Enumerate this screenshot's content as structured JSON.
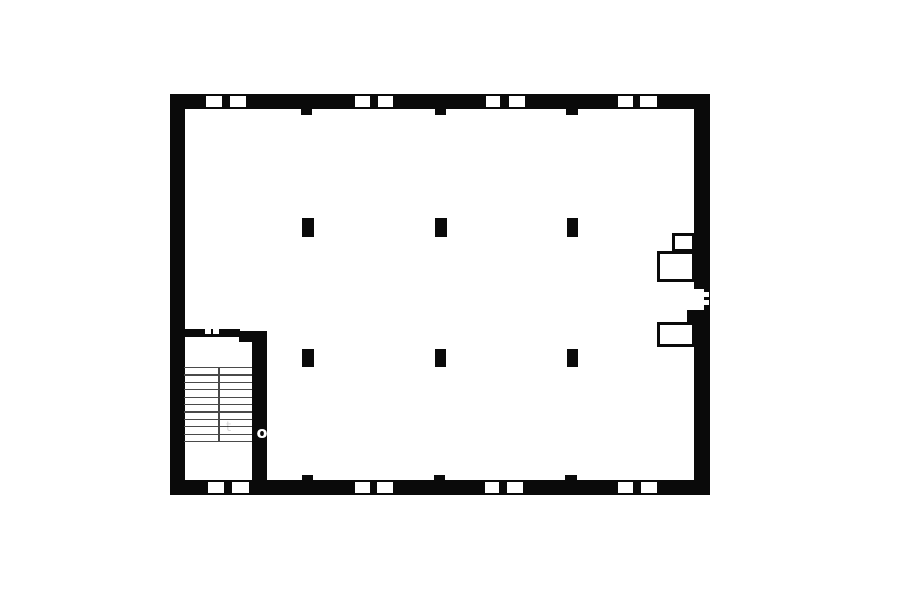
{
  "page": {
    "width": 900,
    "height": 604,
    "background": "#ffffff"
  },
  "floorplan": {
    "ink": "#0a0a0a",
    "paper": "#ffffff",
    "tread_color": "#4a4a4a",
    "walls": [
      {
        "name": "top-wall",
        "x": 170,
        "y": 94,
        "w": 540,
        "h": 15
      },
      {
        "name": "bottom-wall",
        "x": 170,
        "y": 480,
        "w": 540,
        "h": 15
      },
      {
        "name": "left-wall",
        "x": 170,
        "y": 94,
        "w": 15,
        "h": 401
      },
      {
        "name": "right-wall-upper",
        "x": 694,
        "y": 94,
        "w": 16,
        "h": 195
      },
      {
        "name": "right-wall-lower",
        "x": 694,
        "y": 310,
        "w": 16,
        "h": 185
      },
      {
        "name": "door-jamb-strip",
        "x": 703.5,
        "y": 289,
        "w": 6.5,
        "h": 21
      },
      {
        "name": "door-pier",
        "x": 686.5,
        "y": 310,
        "w": 8,
        "h": 13
      },
      {
        "name": "stair-top-wall",
        "x": 185,
        "y": 329,
        "w": 55,
        "h": 8
      },
      {
        "name": "stair-wall-head",
        "x": 239,
        "y": 331,
        "w": 28,
        "h": 11
      },
      {
        "name": "stair-side-wall",
        "x": 252,
        "y": 338,
        "w": 15,
        "h": 142
      }
    ],
    "piers": [
      {
        "name": "pier-top-1",
        "x": 300.5,
        "y": 109,
        "w": 11,
        "h": 5.5
      },
      {
        "name": "pier-top-2",
        "x": 434.5,
        "y": 109,
        "w": 11,
        "h": 5.5
      },
      {
        "name": "pier-top-3",
        "x": 565.5,
        "y": 109,
        "w": 12,
        "h": 5.5
      },
      {
        "name": "pier-bottom-1",
        "x": 301.5,
        "y": 475,
        "w": 11.5,
        "h": 5
      },
      {
        "name": "pier-bottom-2",
        "x": 433.5,
        "y": 475,
        "w": 11.5,
        "h": 5
      },
      {
        "name": "pier-bottom-3",
        "x": 565,
        "y": 475,
        "w": 12,
        "h": 5
      }
    ],
    "columns": [
      {
        "name": "column-r1-c1",
        "x": 301.5,
        "y": 218,
        "w": 12,
        "h": 18.5
      },
      {
        "name": "column-r1-c2",
        "x": 435,
        "y": 218,
        "w": 11.5,
        "h": 18.5
      },
      {
        "name": "column-r1-c3",
        "x": 566.5,
        "y": 218,
        "w": 11.5,
        "h": 18.5
      },
      {
        "name": "column-r2-c1",
        "x": 301.5,
        "y": 348.5,
        "w": 12,
        "h": 18
      },
      {
        "name": "column-r2-c2",
        "x": 434.5,
        "y": 348.5,
        "w": 11.5,
        "h": 18
      },
      {
        "name": "column-r2-c3",
        "x": 566.5,
        "y": 348.5,
        "w": 11.5,
        "h": 18
      }
    ],
    "window_openings": [
      {
        "name": "window-top-1",
        "x": 206,
        "y": 96,
        "w": 15.5,
        "h": 11
      },
      {
        "name": "window-top-2",
        "x": 230,
        "y": 96,
        "w": 16,
        "h": 11
      },
      {
        "name": "window-top-3",
        "x": 354.5,
        "y": 96,
        "w": 15,
        "h": 11
      },
      {
        "name": "window-top-4",
        "x": 377.5,
        "y": 96,
        "w": 15.5,
        "h": 11
      },
      {
        "name": "window-top-5",
        "x": 486,
        "y": 96,
        "w": 14,
        "h": 11
      },
      {
        "name": "window-top-6",
        "x": 508.5,
        "y": 96,
        "w": 16,
        "h": 11
      },
      {
        "name": "window-top-7",
        "x": 617.5,
        "y": 96,
        "w": 15,
        "h": 11
      },
      {
        "name": "window-top-8",
        "x": 639.5,
        "y": 96,
        "w": 17.5,
        "h": 11
      },
      {
        "name": "window-bottom-1",
        "x": 208,
        "y": 481.5,
        "w": 16,
        "h": 11
      },
      {
        "name": "window-bottom-2",
        "x": 231.5,
        "y": 481.5,
        "w": 17.5,
        "h": 11
      },
      {
        "name": "window-bottom-3",
        "x": 355,
        "y": 481.5,
        "w": 15,
        "h": 11
      },
      {
        "name": "window-bottom-4",
        "x": 377,
        "y": 481.5,
        "w": 16,
        "h": 11
      },
      {
        "name": "window-bottom-5",
        "x": 484.5,
        "y": 481.5,
        "w": 14,
        "h": 11
      },
      {
        "name": "window-bottom-6",
        "x": 507,
        "y": 481.5,
        "w": 16,
        "h": 11
      },
      {
        "name": "window-bottom-7",
        "x": 618,
        "y": 481.5,
        "w": 15,
        "h": 11
      },
      {
        "name": "window-bottom-8",
        "x": 641,
        "y": 481.5,
        "w": 16,
        "h": 11
      }
    ],
    "wall_dashes": [
      {
        "name": "stair-wall-dash-1",
        "x": 204.5,
        "y": 329,
        "w": 6,
        "h": 4.5
      },
      {
        "name": "stair-wall-dash-2",
        "x": 212.5,
        "y": 329,
        "w": 6,
        "h": 4.5
      },
      {
        "name": "door-dash-1",
        "x": 704,
        "y": 292,
        "w": 5,
        "h": 4.5
      },
      {
        "name": "door-dash-2",
        "x": 704,
        "y": 300,
        "w": 5,
        "h": 4.5
      }
    ],
    "ducts": [
      {
        "name": "duct-upper-small",
        "x": 671.5,
        "y": 233,
        "w": 23,
        "h": 19
      },
      {
        "name": "duct-upper-large",
        "x": 656.5,
        "y": 251,
        "w": 38,
        "h": 31
      },
      {
        "name": "duct-lower",
        "x": 656.5,
        "y": 321.5,
        "w": 38,
        "h": 25.5
      }
    ],
    "stairs": {
      "x": 184,
      "w": 68,
      "y_start": 367,
      "step": 7.4,
      "tread_count": 11,
      "line_thickness": 1.3,
      "divider_x": 218.3,
      "divider_w": 1.4
    },
    "watermark": [
      {
        "char": "o",
        "x": 256.5,
        "y": 424.5,
        "size": 16,
        "weight": 700,
        "color": "#ffffff"
      },
      {
        "char": "t",
        "x": 226,
        "y": 421,
        "size": 13,
        "weight": 400,
        "color": "rgba(0,0,0,0.16)"
      }
    ]
  }
}
